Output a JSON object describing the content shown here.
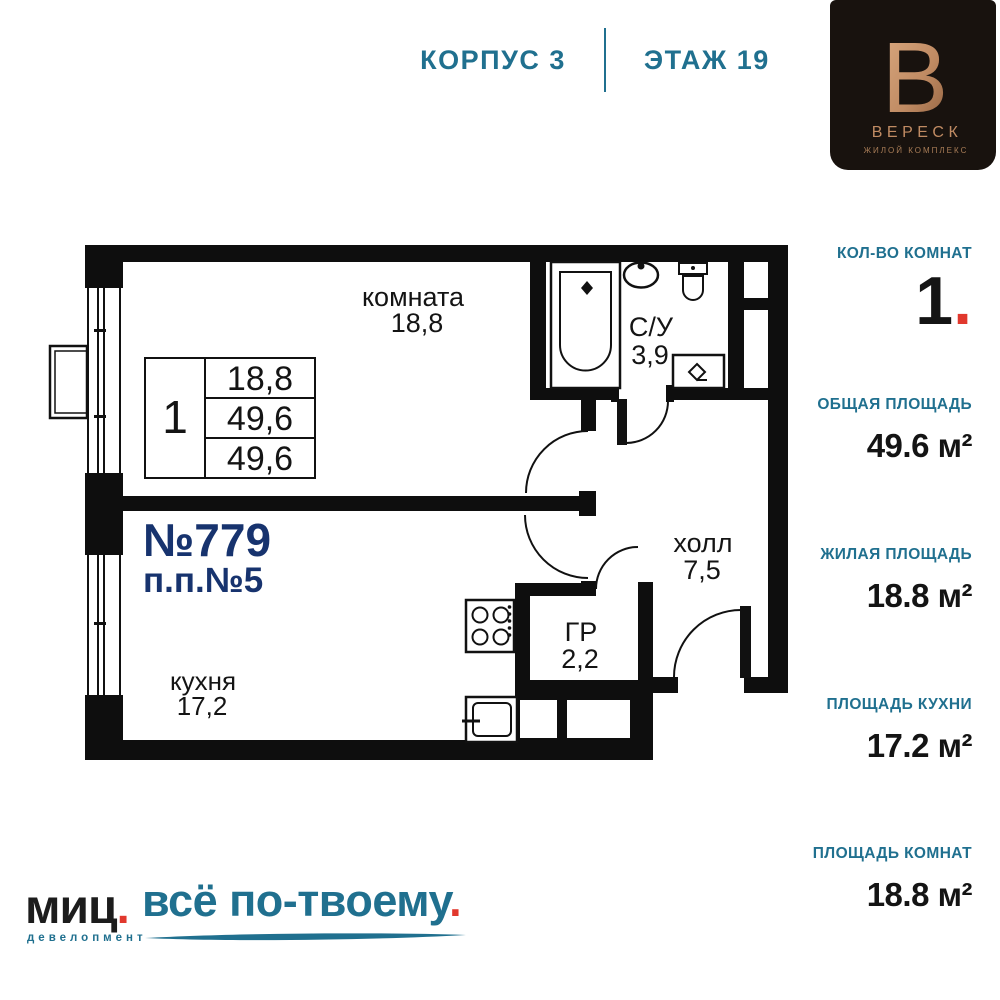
{
  "colors": {
    "teal": "#20708F",
    "navy": "#17336E",
    "red": "#E1382D",
    "copper": "#C08B63",
    "logo_background": "#18120E",
    "wall_black": "#0E0E0E"
  },
  "header": {
    "block_label": "КОРПУС 3",
    "floor_label": "ЭТАЖ 19"
  },
  "brand": {
    "letter": "В",
    "name": "ВЕРЕСК",
    "subtitle": "ЖИЛОЙ КОМПЛЕКС"
  },
  "plan": {
    "apartment_number": "№779",
    "plan_position": "п.п.№5",
    "rooms": {
      "living": {
        "name": "комната",
        "area": "18,8"
      },
      "bathroom": {
        "name": "С/У",
        "area": "3,9"
      },
      "hall": {
        "name": "холл",
        "area": "7,5"
      },
      "wardrobe": {
        "name": "ГР",
        "area": "2,2"
      },
      "kitchen": {
        "name": "кухня",
        "area": "17,2"
      }
    },
    "info_table": {
      "rooms_count": "1",
      "living_area": "18,8",
      "total_area": "49,6",
      "total_area_2": "49,6"
    }
  },
  "sidebar": {
    "rooms_label": "КОЛ-ВО КОМНАТ",
    "rooms_value": "1",
    "rooms_dot": ".",
    "total_label": "ОБЩАЯ ПЛОЩАДЬ",
    "total_value": "49.6 м²",
    "living_label": "ЖИЛАЯ ПЛОЩАДЬ",
    "living_value": "18.8 м²",
    "kitchen_label": "ПЛОЩАДЬ КУХНИ",
    "kitchen_value": "17.2 м²",
    "rooms_area_label": "ПЛОЩАДЬ КОМНАТ",
    "rooms_area_value": "18.8 м²"
  },
  "footer": {
    "logo_text": "миц",
    "logo_dot": ".",
    "logo_caption": "девелопмент",
    "tagline": "всё по-твоему",
    "tagline_dot": "."
  }
}
